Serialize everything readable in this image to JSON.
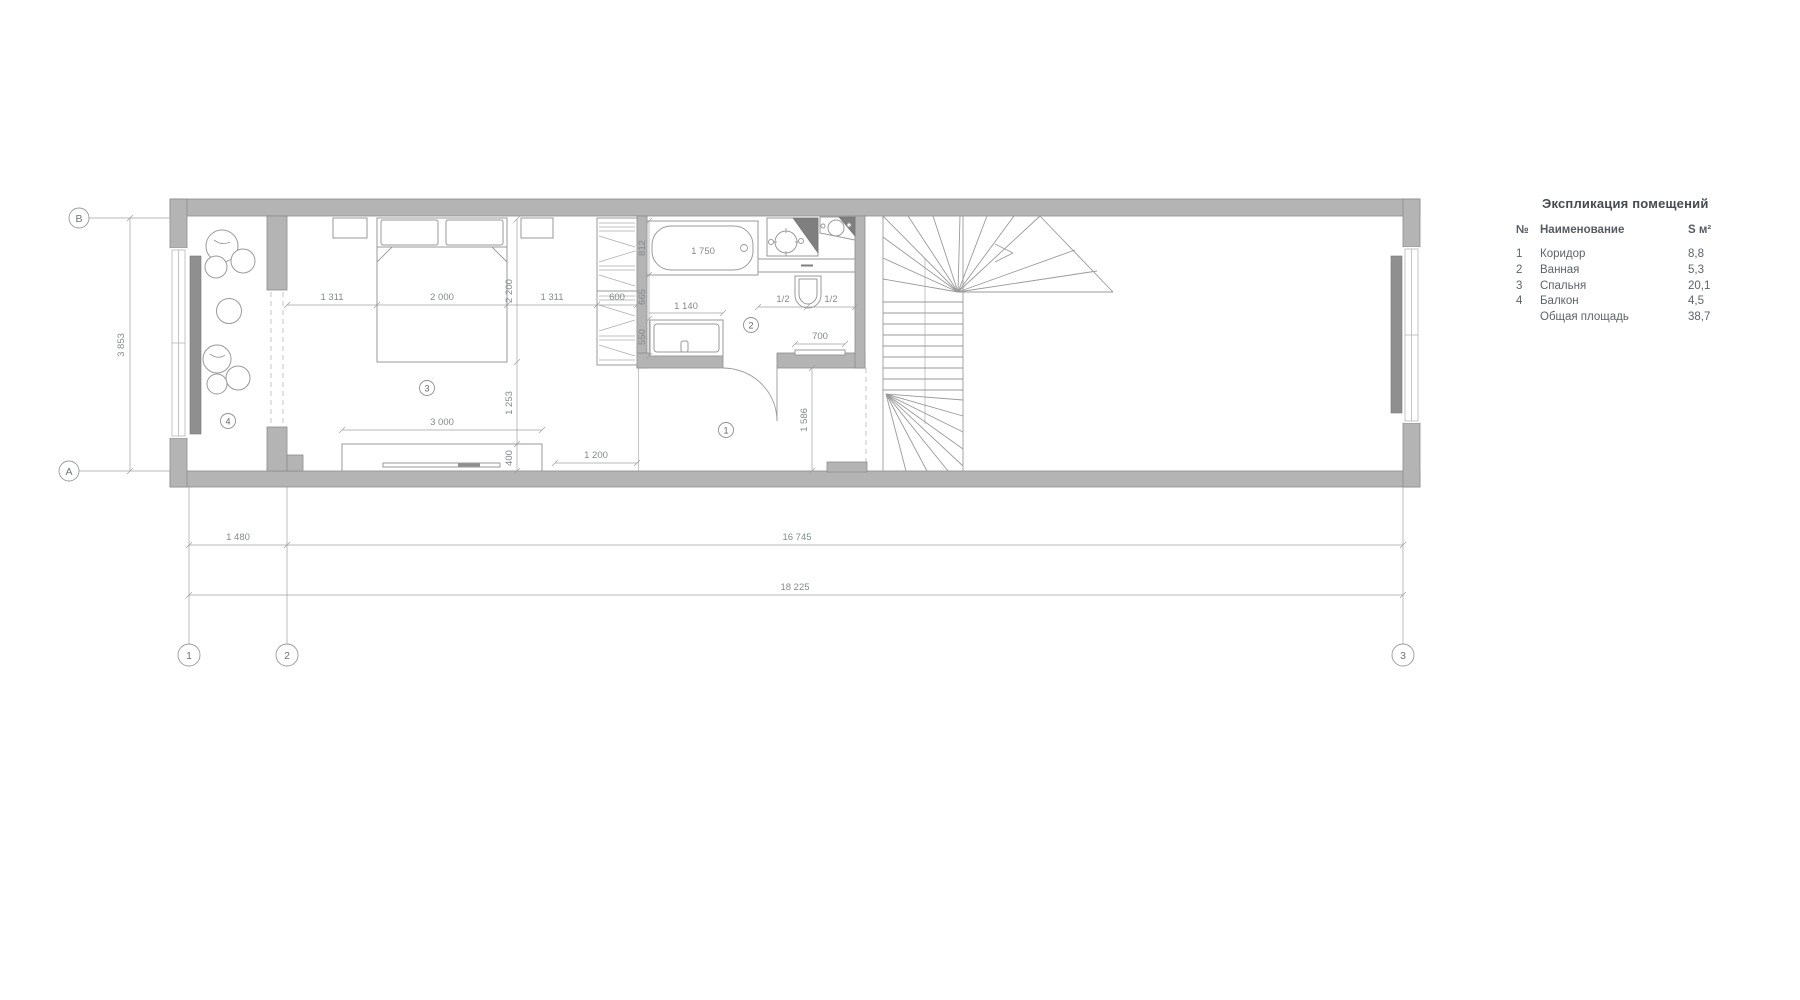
{
  "legend": {
    "title": "Экспликация помещений",
    "col_num": "№",
    "col_name": "Наименование",
    "col_area": "S м²",
    "rows": [
      {
        "num": "1",
        "name": "Коридор",
        "area": "8,8"
      },
      {
        "num": "2",
        "name": "Ванная",
        "area": "5,3"
      },
      {
        "num": "3",
        "name": "Спальня",
        "area": "20,1"
      },
      {
        "num": "4",
        "name": "Балкон",
        "area": "4,5"
      }
    ],
    "total": {
      "num": "",
      "name": "Общая площадь",
      "area": "38,7"
    }
  },
  "axes": {
    "row_top": "В",
    "row_bottom": "А",
    "col_1": "1",
    "col_2": "2",
    "col_3": "3"
  },
  "rooms": {
    "corridor": "1",
    "bathroom": "2",
    "bedroom": "3",
    "balcony": "4"
  },
  "dims": {
    "axis_ab": "3 853",
    "grid_12": "1 480",
    "grid_23": "16 745",
    "grid_13": "18 225",
    "bed_left": "1 311",
    "bed_width": "2 000",
    "bed_right": "1 311",
    "wardrobe_width": "600",
    "bed_length": "2 200",
    "bed_to_console": "1 253",
    "console_depth": "400",
    "console_width": "3 000",
    "passage": "1 200",
    "tub_width": "812",
    "tub_gap": "665",
    "washer_depth": "550",
    "washer_width": "1 140",
    "tub_length": "1 750",
    "wc_half_left": "1/2",
    "wc_half_right": "1/2",
    "towel_rail": "700",
    "hall_depth": "1 586"
  },
  "colors": {
    "wall": "#b4b4b4",
    "dark_fixture": "#7f7f7f",
    "line": "#9a9a9a",
    "dim_text": "#85898b"
  }
}
